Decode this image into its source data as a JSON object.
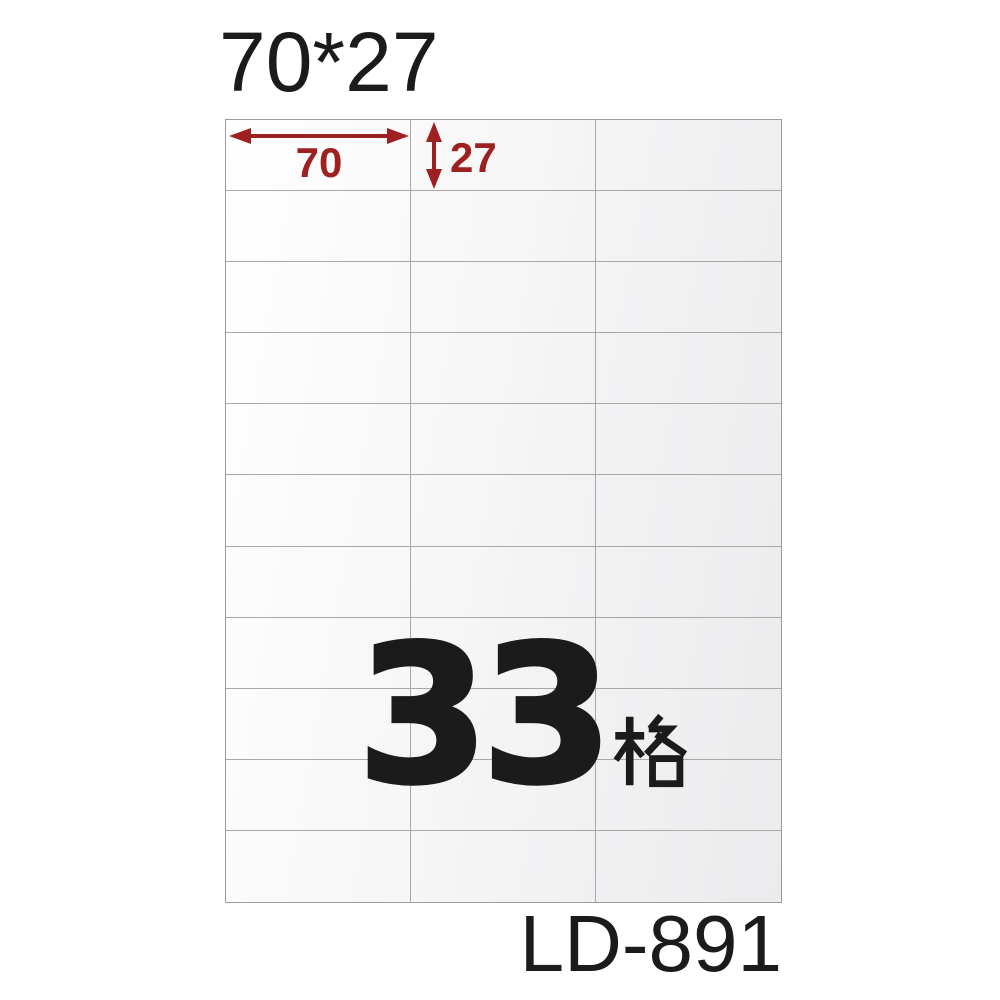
{
  "title": "70*27",
  "product_code": "LD-891",
  "center_label": {
    "number": "33",
    "unit": "格",
    "full": "33格"
  },
  "dimensions": {
    "width_label": "70",
    "height_label": "27"
  },
  "grid": {
    "columns": 3,
    "rows": 11,
    "total_cells": 33
  },
  "colors": {
    "dimension_red": "#9e2020",
    "text_black": "#1b1b1b",
    "grid_line": "#a8a8a8",
    "sheet_border": "#9c9c9c",
    "cell_fill_light": "#ffffff",
    "cell_fill_dark": "#ebebed"
  }
}
